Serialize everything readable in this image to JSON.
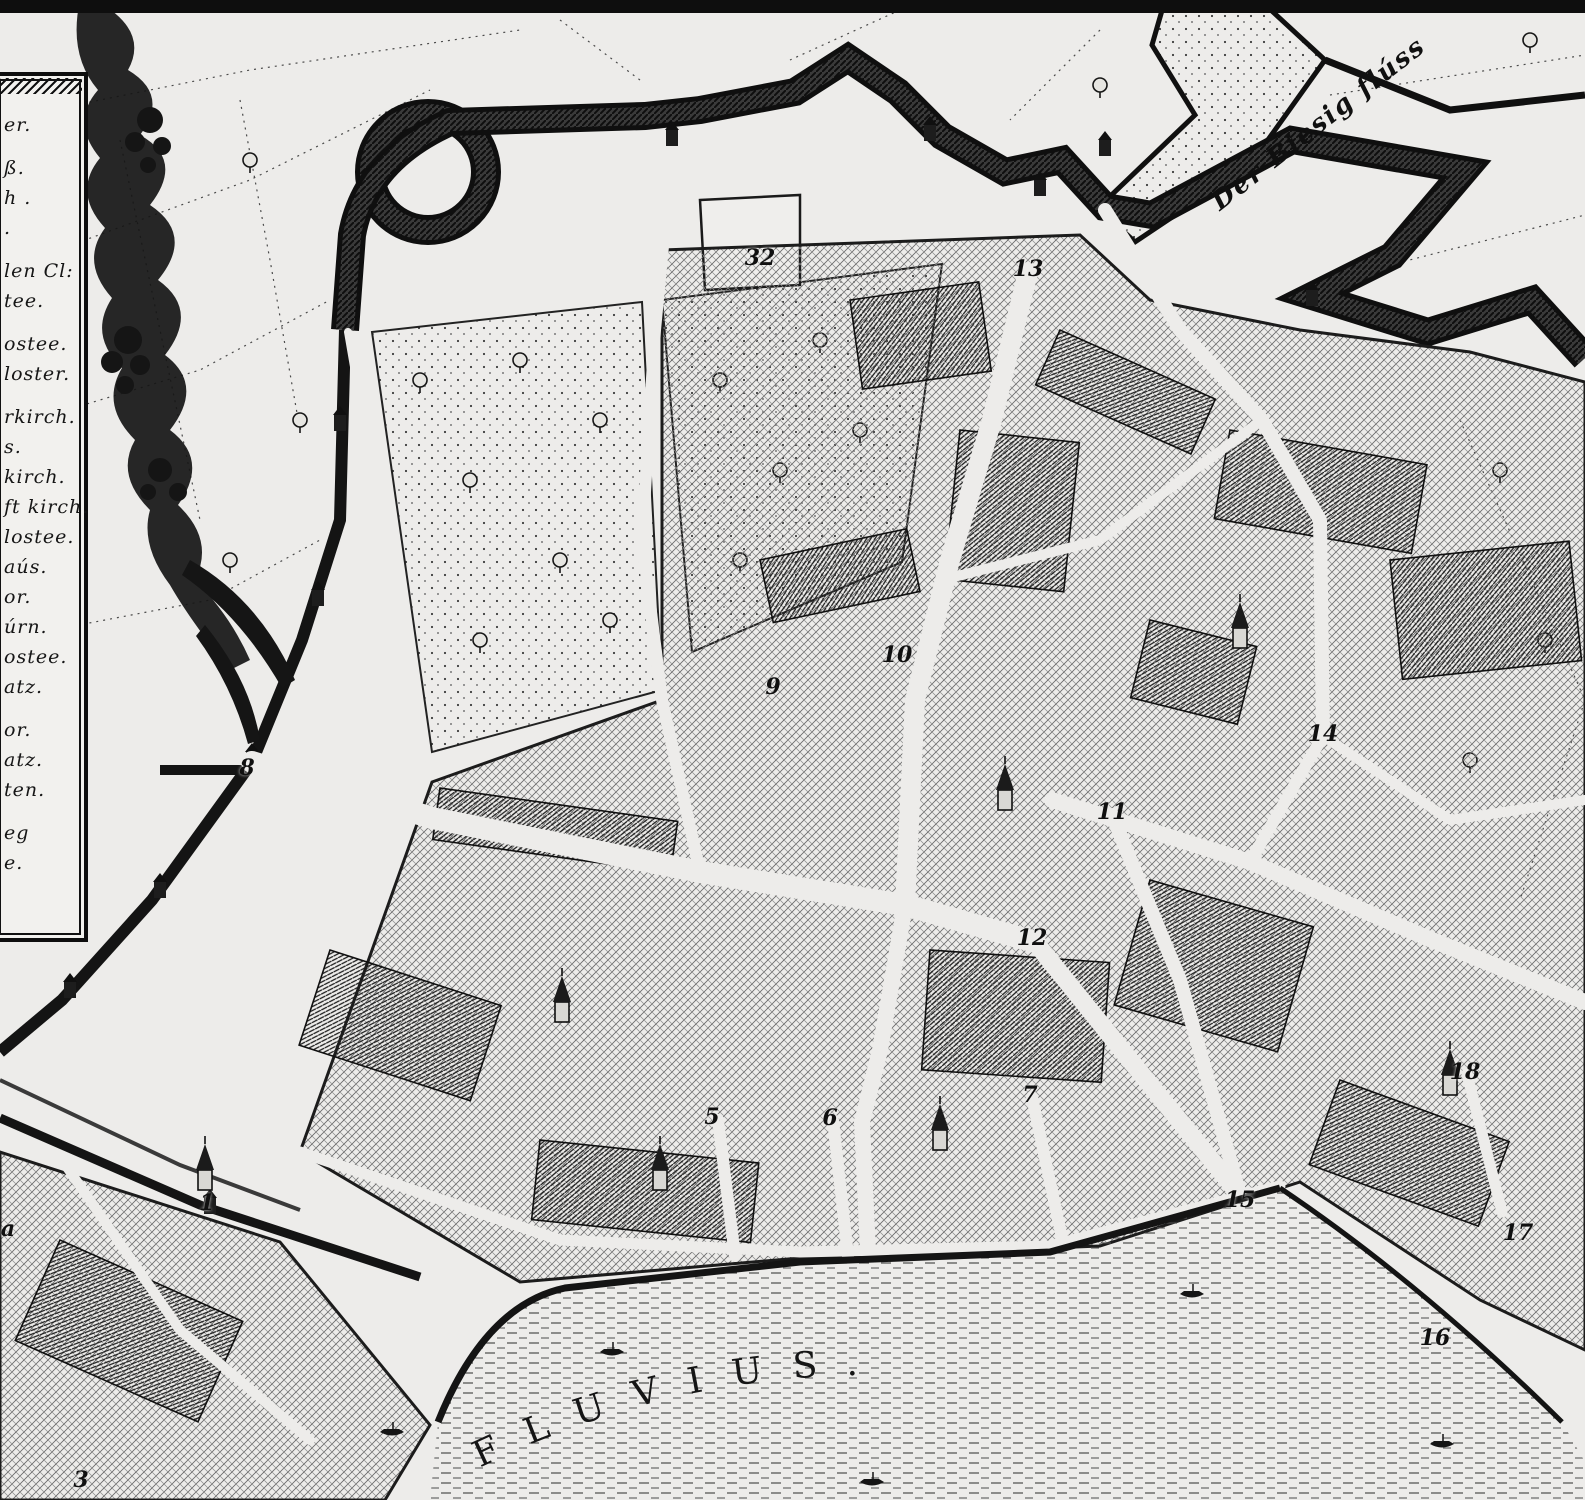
{
  "colors": {
    "paper": "#edecea",
    "ink": "#141414"
  },
  "legend": {
    "lines": [
      {
        "text": "er."
      },
      {
        "text": "ß.",
        "gap": true
      },
      {
        "text": "h ."
      },
      {
        "text": "."
      },
      {
        "text": "len Cl:",
        "gap": true
      },
      {
        "text": "tee."
      },
      {
        "text": "ostee.",
        "gap": true
      },
      {
        "text": "loster."
      },
      {
        "text": "rkirch.",
        "gap": true
      },
      {
        "text": "s."
      },
      {
        "text": "kirch."
      },
      {
        "text": "ft kirch."
      },
      {
        "text": "lostee."
      },
      {
        "text": "aús."
      },
      {
        "text": "or."
      },
      {
        "text": "úrn."
      },
      {
        "text": "ostee."
      },
      {
        "text": "atz."
      },
      {
        "text": "or.",
        "gap": true
      },
      {
        "text": "atz."
      },
      {
        "text": "ten."
      },
      {
        "text": "eg",
        "gap": true
      },
      {
        "text": "e."
      }
    ]
  },
  "labels": {
    "river": "FLUVIUS.",
    "stream": "Der Biesig flúss"
  },
  "markers": [
    {
      "label": "a",
      "x": 8,
      "y": 1229
    },
    {
      "label": "1",
      "x": 207,
      "y": 1203
    },
    {
      "label": "3",
      "x": 81,
      "y": 1480
    },
    {
      "label": "5",
      "x": 712,
      "y": 1117
    },
    {
      "label": "6",
      "x": 830,
      "y": 1118
    },
    {
      "label": "7",
      "x": 1030,
      "y": 1095
    },
    {
      "label": "8",
      "x": 247,
      "y": 768
    },
    {
      "label": "9",
      "x": 773,
      "y": 687
    },
    {
      "label": "10",
      "x": 897,
      "y": 655
    },
    {
      "label": "11",
      "x": 1112,
      "y": 812
    },
    {
      "label": "12",
      "x": 1032,
      "y": 938
    },
    {
      "label": "13",
      "x": 1028,
      "y": 269
    },
    {
      "label": "14",
      "x": 1323,
      "y": 734
    },
    {
      "label": "15",
      "x": 1240,
      "y": 1200
    },
    {
      "label": "16",
      "x": 1435,
      "y": 1338
    },
    {
      "label": "17",
      "x": 1518,
      "y": 1233
    },
    {
      "label": "18",
      "x": 1465,
      "y": 1072
    },
    {
      "label": "32",
      "x": 760,
      "y": 258
    }
  ]
}
